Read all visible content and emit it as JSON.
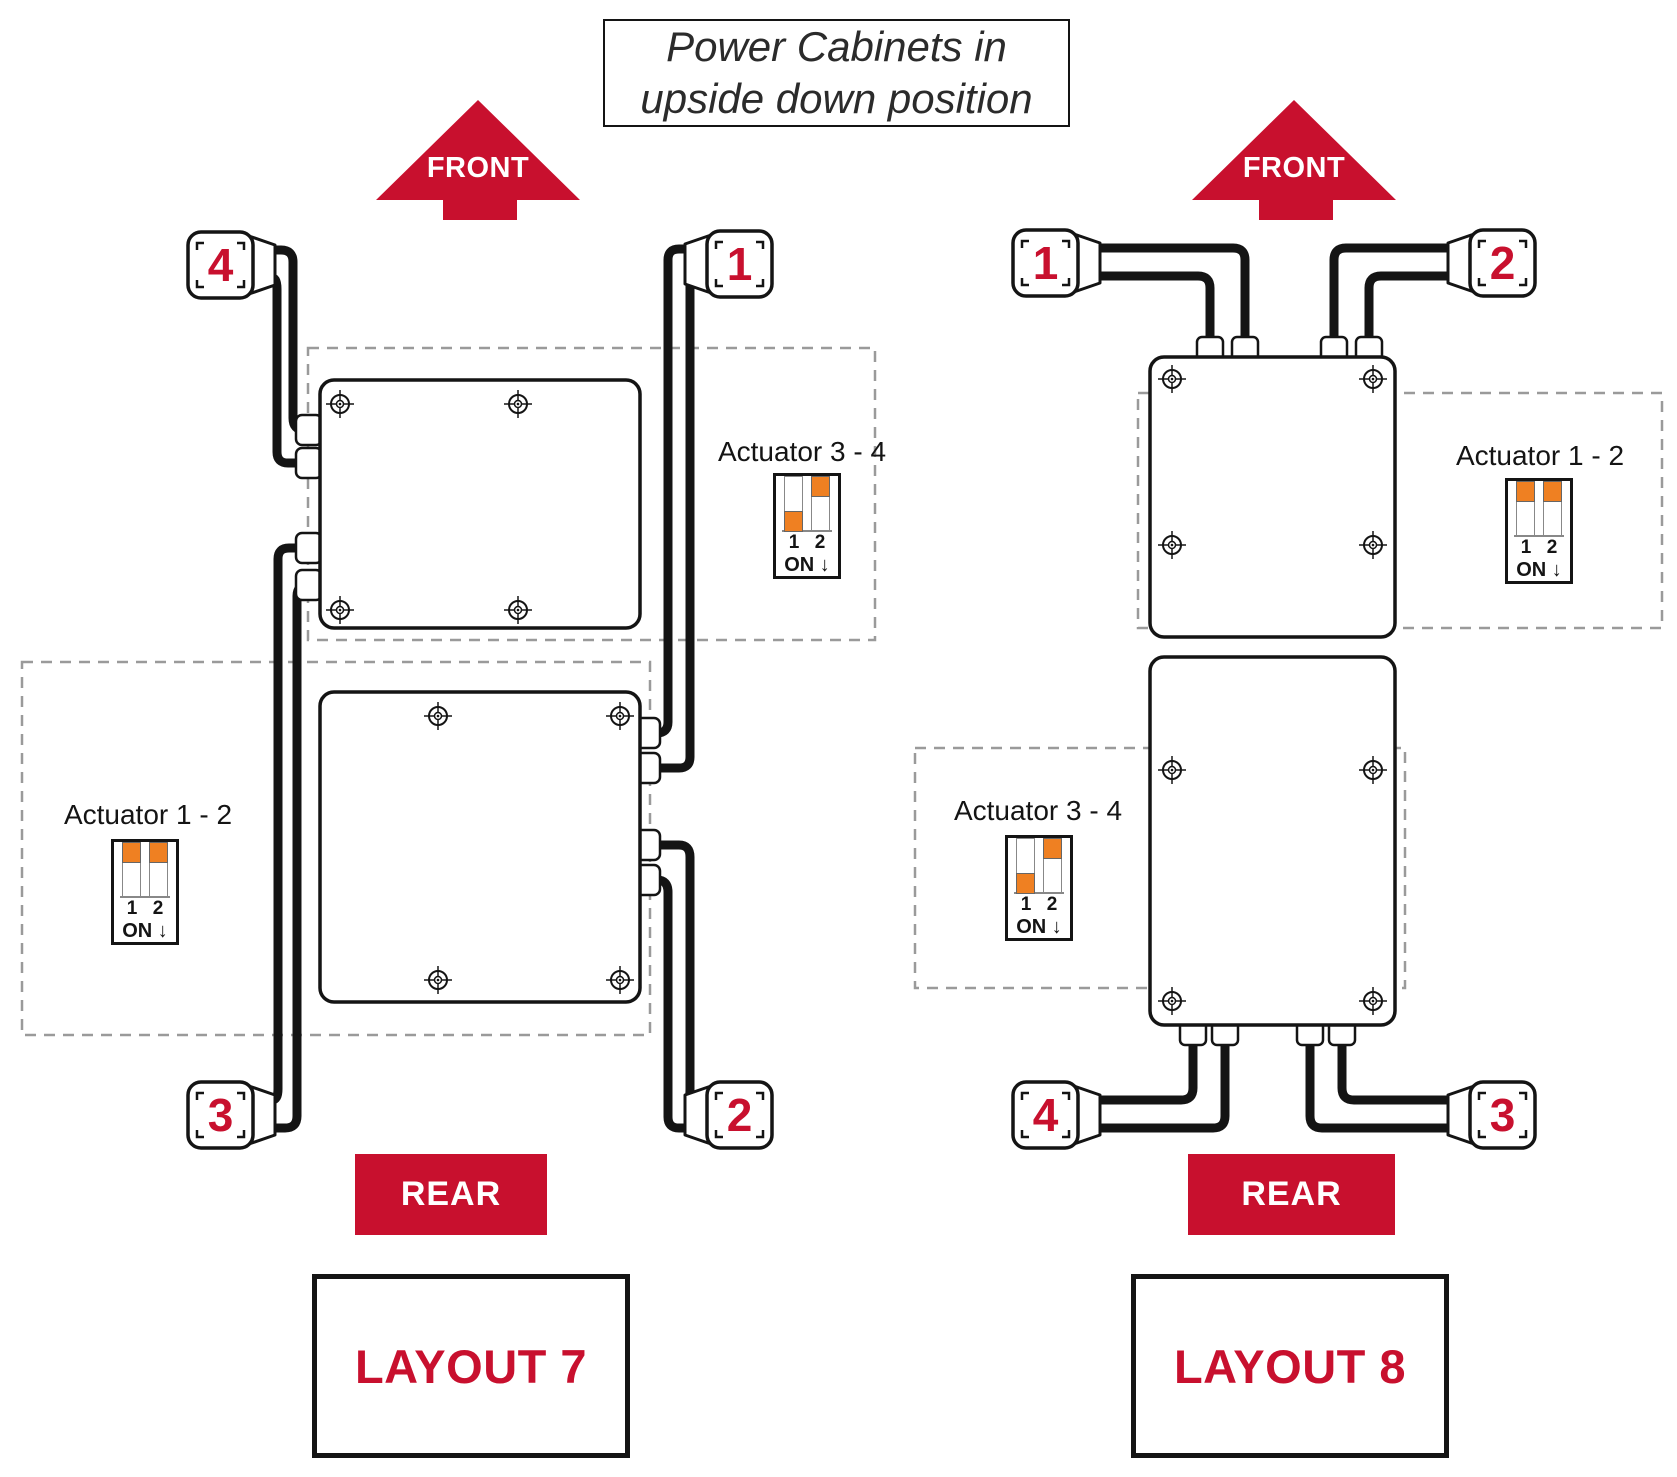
{
  "title": {
    "line1": "Power Cabinets in",
    "line2": "upside down position"
  },
  "colors": {
    "red": "#C8102E",
    "orange": "#EF8022",
    "line": "#141414",
    "dash": "#9a9a9a"
  },
  "labels": {
    "front": "FRONT",
    "rear": "REAR"
  },
  "layout7": {
    "name": "LAYOUT 7",
    "connectors": {
      "top_left": "4",
      "top_right": "1",
      "bottom_left": "3",
      "bottom_right": "2"
    },
    "actuator_34": {
      "label": "Actuator 3 - 4",
      "pins": [
        "1",
        "2"
      ],
      "on": "ON ↓",
      "switches": [
        "down",
        "up"
      ]
    },
    "actuator_12": {
      "label": "Actuator 1 - 2",
      "pins": [
        "1",
        "2"
      ],
      "on": "ON ↓",
      "switches": [
        "up",
        "up"
      ]
    }
  },
  "layout8": {
    "name": "LAYOUT 8",
    "connectors": {
      "top_left": "1",
      "top_right": "2",
      "bottom_left": "4",
      "bottom_right": "3"
    },
    "actuator_12": {
      "label": "Actuator 1 - 2",
      "pins": [
        "1",
        "2"
      ],
      "on": "ON ↓",
      "switches": [
        "up",
        "up"
      ]
    },
    "actuator_34": {
      "label": "Actuator 3 - 4",
      "pins": [
        "1",
        "2"
      ],
      "on": "ON ↓",
      "switches": [
        "down",
        "up"
      ]
    }
  }
}
